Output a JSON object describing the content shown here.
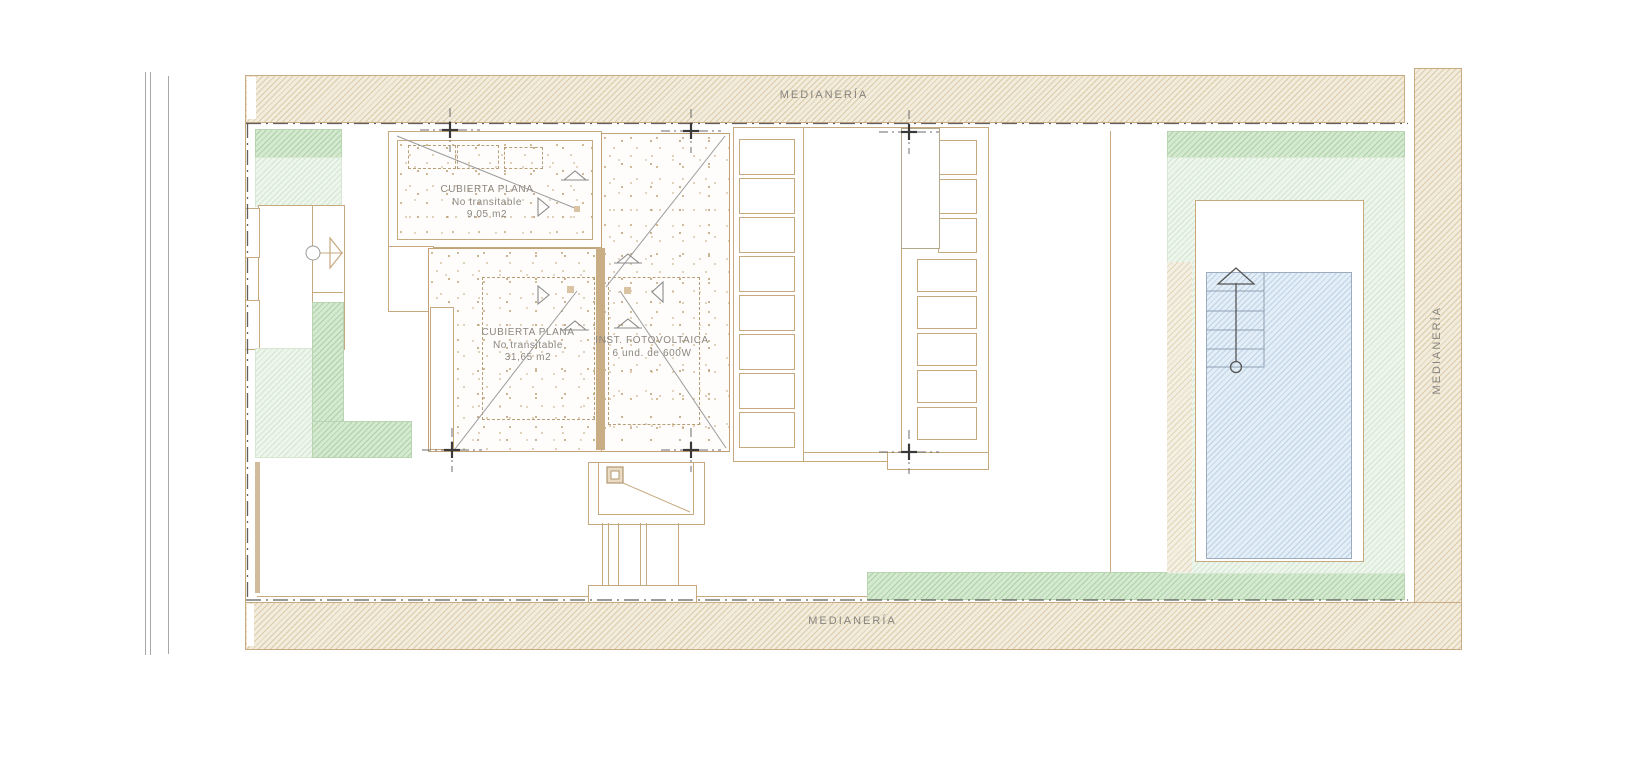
{
  "drawing": {
    "type": "roof-plan",
    "party_walls": {
      "top": "MEDIANERÍA",
      "bottom": "MEDIANERÍA",
      "right": "MEDIANERÍA"
    },
    "roof_small": {
      "title": "CUBIERTA PLANA",
      "subtitle": "No transitable",
      "area": "9,05 m2"
    },
    "roof_main": {
      "title": "CUBIERTA PLANA",
      "subtitle": "No transitable",
      "area": "31,65 m2"
    },
    "photovoltaic": {
      "title": "INST. FOTOVOLTAICA",
      "subtitle": "6 und. de 600W"
    }
  },
  "colors": {
    "line_tan": "#c6a97f",
    "hatch_beige_line": "#dccaa9",
    "green_dark": "#abd1a6",
    "green_light": "#d2e7d0",
    "pool_blue": "#bed2e8",
    "text_gray": "#88847d",
    "boundary_dash": "#5f5f5f"
  }
}
